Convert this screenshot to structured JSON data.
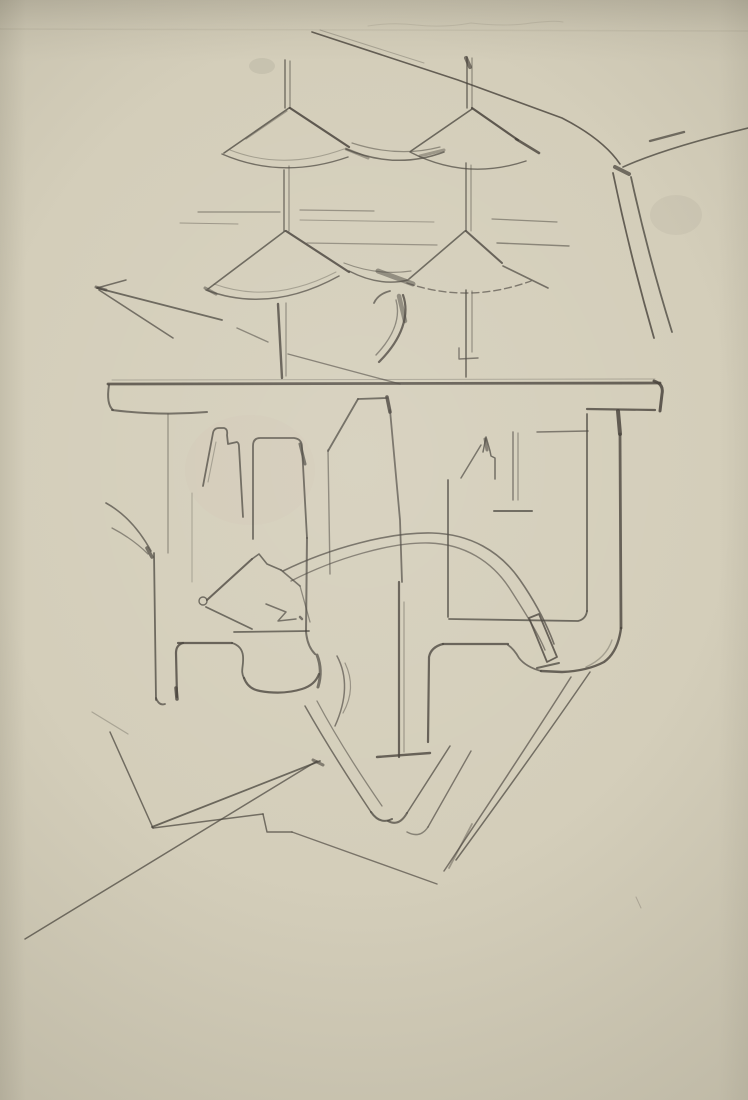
{
  "artwork": {
    "type": "pencil-sketch-photo",
    "description": "Hand-drawn pencil study: four conical umbrella roofs on thin masts above a plan-like structure with towers, U-channels, rounded feet and sweeping road lines on cream paper",
    "paper_color": "#d4ceba",
    "paper_shadow_color": "#c7c1ae",
    "pencil_color": "#46413a"
  },
  "canvas": {
    "width": 748,
    "height": 1100
  },
  "smudges": [
    {
      "name": "graphite-smudge-top-left-of-mast",
      "cx": 262,
      "cy": 66,
      "rx": 13,
      "ry": 8,
      "o": 0.1,
      "fill": "#5a554a"
    },
    {
      "name": "graphite-smudge-right-of-road",
      "cx": 676,
      "cy": 215,
      "rx": 26,
      "ry": 20,
      "o": 0.06,
      "fill": "#5a554a"
    },
    {
      "name": "warm-tint-left-chamber",
      "cx": 250,
      "cy": 470,
      "rx": 65,
      "ry": 55,
      "o": 0.05,
      "fill": "#c89f96"
    }
  ],
  "strokes": [
    {
      "name": "faint-top-scribble",
      "d": "M368,26 q25,-4 48,-1 q28,3 55,-2 q35,4 60,0 q25,-3 32,-1",
      "w": 1,
      "o": 0.12
    },
    {
      "name": "paper-crease-line",
      "d": "M0,29 L748,31",
      "w": 1.5,
      "o": 0.07
    },
    {
      "name": "left-mast-upper-a",
      "d": "M285,60 L285,108",
      "w": 1.4,
      "o": 0.7
    },
    {
      "name": "left-mast-upper-b",
      "d": "M290,61 L290,108",
      "w": 1.2,
      "o": 0.55
    },
    {
      "name": "left-mast-mid-a",
      "d": "M284,170 L284,231",
      "w": 1.4,
      "o": 0.7
    },
    {
      "name": "left-mast-mid-b",
      "d": "M289,166 L289,231",
      "w": 1.2,
      "o": 0.5
    },
    {
      "name": "left-mast-lower-a",
      "d": "M278,304 L282,378",
      "w": 2.4,
      "o": 0.8
    },
    {
      "name": "left-mast-lower-b",
      "d": "M286,303 L286,376",
      "w": 1.2,
      "o": 0.5
    },
    {
      "name": "right-mast-upper-a",
      "d": "M467,57 L467,108",
      "w": 1.4,
      "o": 0.75
    },
    {
      "name": "right-mast-upper-b",
      "d": "M472,58 L472,108",
      "w": 1.2,
      "o": 0.5
    },
    {
      "name": "right-mast-top-blob",
      "d": "M466,58 L470,67",
      "w": 4,
      "o": 0.65
    },
    {
      "name": "right-mast-mid-a",
      "d": "M466,163 L466,231",
      "w": 1.4,
      "o": 0.7
    },
    {
      "name": "right-mast-mid-b",
      "d": "M471,165 L471,231",
      "w": 1.1,
      "o": 0.5
    },
    {
      "name": "right-mast-lower-a",
      "d": "M466,290 L466,377",
      "w": 1.6,
      "o": 0.75
    },
    {
      "name": "right-mast-lower-b",
      "d": "M472,291 L472,352",
      "w": 1.2,
      "o": 0.5
    },
    {
      "name": "right-mast-collar",
      "d": "M459,348 L459,359 L478,358",
      "w": 1.4,
      "o": 0.65
    },
    {
      "name": "cone1-left-edge",
      "d": "M289,108 L224,153",
      "w": 1.6,
      "o": 0.75
    },
    {
      "name": "cone1-left-edge-double",
      "d": "M287,111 L246,139",
      "w": 1.2,
      "o": 0.4
    },
    {
      "name": "cone1-right-edge",
      "d": "M290,108 L349,147",
      "w": 2.2,
      "o": 0.85
    },
    {
      "name": "cone1-bottom-arc",
      "d": "M222,154 Q282,180 348,157",
      "w": 1.4,
      "o": 0.7
    },
    {
      "name": "cone1-bottom-arc-double",
      "d": "M230,150 Q284,171 344,149",
      "w": 1,
      "o": 0.35
    },
    {
      "name": "cone2-left-edge",
      "d": "M472,109 L411,151",
      "w": 1.6,
      "o": 0.75
    },
    {
      "name": "cone2-right-edge",
      "d": "M472,108 L518,140",
      "w": 2.2,
      "o": 0.85
    },
    {
      "name": "cone2-right-tip-dark",
      "d": "M516,139 L539,153",
      "w": 2.6,
      "o": 0.8
    },
    {
      "name": "cone2-bottom-arc",
      "d": "M410,152 Q466,181 526,161",
      "w": 1.4,
      "o": 0.7
    },
    {
      "name": "swag-cone1-cone2-a",
      "d": "M346,149 Q396,170 444,152",
      "w": 1.5,
      "o": 0.7
    },
    {
      "name": "swag-cone1-cone2-b",
      "d": "M352,143 Q398,158 440,147",
      "w": 1.2,
      "o": 0.5
    },
    {
      "name": "swag12-dark-left",
      "d": "M346,149 L368,158",
      "w": 3,
      "o": 0.4
    },
    {
      "name": "swag12-dark-right",
      "d": "M420,156 L444,150",
      "w": 3,
      "o": 0.4
    },
    {
      "name": "cone3-left-edge",
      "d": "M285,231 L208,289",
      "w": 1.6,
      "o": 0.75
    },
    {
      "name": "cone3-right-edge",
      "d": "M286,231 L349,272",
      "w": 2.2,
      "o": 0.85
    },
    {
      "name": "cone3-bottom-arc",
      "d": "M206,290 Q270,314 339,276",
      "w": 1.5,
      "o": 0.7
    },
    {
      "name": "cone3-bottom-arc-double",
      "d": "M214,284 Q272,305 336,272",
      "w": 1,
      "o": 0.35
    },
    {
      "name": "cone3-left-tip-dark",
      "d": "M205,288 L216,294",
      "w": 3,
      "o": 0.5
    },
    {
      "name": "cone4-left-edge",
      "d": "M465,231 L409,279",
      "w": 1.6,
      "o": 0.75
    },
    {
      "name": "cone4-right-edge",
      "d": "M466,231 L502,263",
      "w": 2,
      "o": 0.8
    },
    {
      "name": "cone4-right-extension",
      "d": "M503,266 L548,288",
      "w": 1.6,
      "o": 0.7
    },
    {
      "name": "cone4-bottom-arc-hatched",
      "d": "M407,283 Q468,304 531,281",
      "w": 1.4,
      "o": 0.65,
      "dash": "7 4"
    },
    {
      "name": "swag-cone3-cone4-a",
      "d": "M349,271 Q380,287 408,280",
      "w": 1.5,
      "o": 0.7
    },
    {
      "name": "swag-cone3-cone4-b",
      "d": "M344,263 Q378,276 411,271",
      "w": 1.2,
      "o": 0.5
    },
    {
      "name": "swag34-dark-wedge",
      "d": "M378,271 L413,284",
      "w": 5,
      "o": 0.5
    },
    {
      "name": "curl-hook",
      "d": "M390,291 Q378,294 374,303",
      "w": 1.8,
      "o": 0.7
    },
    {
      "name": "curl-outer",
      "d": "M403,295 C410,315 402,339 379,362",
      "w": 2.2,
      "o": 0.8
    },
    {
      "name": "curl-inner",
      "d": "M396,300 C401,318 393,337 376,355",
      "w": 1.4,
      "o": 0.55
    },
    {
      "name": "curl-dark-core",
      "d": "M399,296 L405,321",
      "w": 4.5,
      "o": 0.5
    },
    {
      "name": "road-main-diagonal",
      "d": "M312,32 L458,80 L562,118 Q603,139 620,164",
      "w": 1.6,
      "o": 0.8
    },
    {
      "name": "road-main-diagonal-double",
      "d": "M320,30 L424,63",
      "w": 1,
      "o": 0.3
    },
    {
      "name": "road-branch-upper-right",
      "d": "M623,167 Q665,148 748,128",
      "w": 1.6,
      "o": 0.75
    },
    {
      "name": "road-branch-dark-restroke",
      "d": "M650,141 L684,132",
      "w": 2.4,
      "o": 0.7
    },
    {
      "name": "road-junction-blob",
      "d": "M615,167 L629,174",
      "w": 4,
      "o": 0.7
    },
    {
      "name": "road-down-branch-a",
      "d": "M613,173 Q630,255 654,338",
      "w": 1.8,
      "o": 0.8
    },
    {
      "name": "road-down-branch-b",
      "d": "M631,177 Q648,255 672,332",
      "w": 1.8,
      "o": 0.75
    },
    {
      "name": "bar-top-twin-line",
      "d": "M112,380 L655,379",
      "w": 1,
      "o": 0.3
    },
    {
      "name": "bar-main-line",
      "d": "M108,384 L660,383",
      "w": 2.8,
      "o": 0.8
    },
    {
      "name": "bar-left-end-curl",
      "d": "M109,385 Q106,404 113,410",
      "w": 2,
      "o": 0.7
    },
    {
      "name": "bar-left-ledge",
      "d": "M112,410 Q160,416 207,412",
      "w": 2,
      "o": 0.7
    },
    {
      "name": "bar-right-end-hook",
      "d": "M654,381 Q664,384 662,394 L660,411",
      "w": 3,
      "o": 0.85
    },
    {
      "name": "bar-right-lower-line",
      "d": "M587,409 L655,410",
      "w": 2.2,
      "o": 0.8
    },
    {
      "name": "inner-vertical-corner-blob",
      "d": "M618,411 L620,434",
      "w": 4,
      "o": 0.85
    },
    {
      "name": "left-chamber-thin-wall",
      "d": "M168,414 L168,553",
      "w": 1.2,
      "o": 0.5
    },
    {
      "name": "tower1-outline",
      "d": "M203,486 L213,433 Q214,428 219,428 L224,428 Q228,429 227,435 L228,444 L237,442 Q239,443 239,447 L243,517",
      "w": 1.8,
      "o": 0.75
    },
    {
      "name": "tower1-inner-stroke",
      "d": "M208,482 L216,442",
      "w": 1.1,
      "o": 0.35
    },
    {
      "name": "faint-vertical-left",
      "d": "M192,493 L192,582",
      "w": 1,
      "o": 0.35
    },
    {
      "name": "tower2-outline",
      "d": "M253,539 L253,446 Q253,438 260,438 L294,438 Q302,439 302,447 L307,538",
      "w": 1.8,
      "o": 0.75
    },
    {
      "name": "tower2-corner-dark",
      "d": "M300,444 L305,464",
      "w": 3,
      "o": 0.7
    },
    {
      "name": "tower2-right-lower-vertical",
      "d": "M307,538 L306,631",
      "w": 2,
      "o": 0.7
    },
    {
      "name": "tower3-left-edge",
      "d": "M330,574 L328,450",
      "w": 1.4,
      "o": 0.55
    },
    {
      "name": "tower3-slant-top",
      "d": "M328,451 L358,399",
      "w": 1.8,
      "o": 0.75
    },
    {
      "name": "tower3-top-edge",
      "d": "M358,399 L387,398",
      "w": 1.8,
      "o": 0.75
    },
    {
      "name": "tower3-corner-dark",
      "d": "M387,397 L390,412",
      "w": 3.5,
      "o": 0.85
    },
    {
      "name": "tower3-right-edge",
      "d": "M390,410 L400,520 L402,582",
      "w": 1.8,
      "o": 0.7
    },
    {
      "name": "kite-tip-circle",
      "d": "M199,601 a4,4 0 1 0 8,0 a4,4 0 1 0 -8,0",
      "w": 1.4,
      "o": 0.75
    },
    {
      "name": "kite-upper-edge",
      "d": "M207,600 L252,559",
      "w": 2,
      "o": 0.8
    },
    {
      "name": "kite-notch",
      "d": "M252,559 L259,554 L267,564 L281,570",
      "w": 1.6,
      "o": 0.75
    },
    {
      "name": "kite-right-edge",
      "d": "M281,570 L300,586",
      "w": 1.6,
      "o": 0.7
    },
    {
      "name": "kite-right-lower-line",
      "d": "M300,586 L310,622",
      "w": 1.3,
      "o": 0.55
    },
    {
      "name": "kite-lower-edge",
      "d": "M206,607 L252,629",
      "w": 1.8,
      "o": 0.75
    },
    {
      "name": "kite-bottom-line",
      "d": "M234,632 L309,631",
      "w": 1.8,
      "o": 0.75
    },
    {
      "name": "kite-inner-zigzag",
      "d": "M266,604 L286,612 L278,621 L296,619",
      "w": 1.5,
      "o": 0.7
    },
    {
      "name": "kite-inner-dot",
      "d": "M300,617 L302,619",
      "w": 2.5,
      "o": 0.7
    },
    {
      "name": "ramp-curve-a",
      "d": "M283,571 C330,548 390,532 432,533 C470,534 500,551 520,580 C536,603 547,625 554,644",
      "w": 1.6,
      "o": 0.7
    },
    {
      "name": "ramp-curve-b",
      "d": "M291,581 C336,558 392,542 429,543 C464,544 492,561 510,589 C524,611 537,631 545,650",
      "w": 1.4,
      "o": 0.6
    },
    {
      "name": "chimney-diagonal",
      "d": "M461,478 L481,445",
      "w": 1.5,
      "o": 0.7
    },
    {
      "name": "chimney-outline",
      "d": "M483,452 L486,437 L490,451 L491,456 L495,458 L495,479",
      "w": 1.5,
      "o": 0.75
    },
    {
      "name": "chimney-dark-tip",
      "d": "M485,439 L487,450",
      "w": 3,
      "o": 0.6
    },
    {
      "name": "right-chamber-double-vert-a",
      "d": "M513,432 L513,500",
      "w": 1.4,
      "o": 0.65
    },
    {
      "name": "right-chamber-double-vert-b",
      "d": "M518,433 L518,500",
      "w": 1.2,
      "o": 0.5
    },
    {
      "name": "right-chamber-base-tick",
      "d": "M494,511 L532,511",
      "w": 2,
      "o": 0.75
    },
    {
      "name": "right-chamber-horizontal",
      "d": "M537,432 L588,431",
      "w": 1.5,
      "o": 0.65
    },
    {
      "name": "right-chamber-left-wall",
      "d": "M448,480 L448,617",
      "w": 1.8,
      "o": 0.75
    },
    {
      "name": "right-chamber-bottom",
      "d": "M449,619 L578,621 Q586,619 587,611",
      "w": 1.8,
      "o": 0.75
    },
    {
      "name": "right-chamber-right-wall",
      "d": "M587,611 L587,414",
      "w": 1.8,
      "o": 0.75
    },
    {
      "name": "inner-thick-vertical",
      "d": "M620,434 L621,628",
      "w": 2.8,
      "o": 0.8
    },
    {
      "name": "right-leg-bottom-curve",
      "d": "M621,628 Q618,652 604,662 Q587,671 562,672 L541,671",
      "w": 2.4,
      "o": 0.8
    },
    {
      "name": "right-leg-valley",
      "d": "M541,671 Q526,667 519,658 Q514,649 508,645",
      "w": 1.8,
      "o": 0.7
    },
    {
      "name": "right-leg-inner-horizontal",
      "d": "M443,644 L508,644",
      "w": 2.2,
      "o": 0.8
    },
    {
      "name": "right-leg-left-corner",
      "d": "M443,644 Q431,647 429,657 L428,742",
      "w": 2.2,
      "o": 0.8
    },
    {
      "name": "right-leg-inner-shadow",
      "d": "M612,640 Q606,658 586,667",
      "w": 1.4,
      "o": 0.35
    },
    {
      "name": "central-leg-left-edge",
      "d": "M399,582 L399,757",
      "w": 2.2,
      "o": 0.8
    },
    {
      "name": "central-leg-twin",
      "d": "M404,602 L404,752",
      "w": 1.2,
      "o": 0.4
    },
    {
      "name": "central-leg-foot",
      "d": "M377,757 L430,753",
      "w": 2.4,
      "o": 0.8
    },
    {
      "name": "rotated-rectangle",
      "d": "M529,618 L539,614 L557,657 L547,662 Z",
      "w": 1.8,
      "o": 0.8
    },
    {
      "name": "rotated-rectangle-tick",
      "d": "M537,668 L559,663",
      "w": 2,
      "o": 0.75
    },
    {
      "name": "left-outer-wall",
      "d": "M154,553 L156,700",
      "w": 1.8,
      "o": 0.75
    },
    {
      "name": "left-outer-wall-hook",
      "d": "M156,698 Q159,706 165,704",
      "w": 1.8,
      "o": 0.7
    },
    {
      "name": "grass-blade-a",
      "d": "M106,503 Q133,518 151,551",
      "w": 1.6,
      "o": 0.7
    },
    {
      "name": "grass-blade-b",
      "d": "M112,528 Q133,539 148,554",
      "w": 1.3,
      "o": 0.55
    },
    {
      "name": "grass-blade-dark-tip",
      "d": "M147,548 L152,557",
      "w": 3.5,
      "o": 0.7
    },
    {
      "name": "left-foot-top",
      "d": "M178,643 L232,643",
      "w": 2.2,
      "o": 0.8
    },
    {
      "name": "left-foot-left-corner",
      "d": "M183,643 Q176,645 176,653 L177,697",
      "w": 2.2,
      "o": 0.8
    },
    {
      "name": "left-foot-left-dark-end",
      "d": "M176,688 L177,699",
      "w": 3.5,
      "o": 0.8
    },
    {
      "name": "left-foot-right-corner",
      "d": "M232,643 Q242,646 243,656 C244,666 240,671 244,678",
      "w": 1.8,
      "o": 0.75
    },
    {
      "name": "central-foot-bottom-curve",
      "d": "M244,678 Q248,689 260,691 Q283,695 302,689 Q315,685 319,674",
      "w": 2.2,
      "o": 0.8
    },
    {
      "name": "central-foot-knob",
      "d": "M317,655 Q323,670 318,687",
      "w": 3,
      "o": 0.7
    },
    {
      "name": "central-foot-corner",
      "d": "M306,631 Q307,646 315,654",
      "w": 2,
      "o": 0.7
    },
    {
      "name": "parenthesis-arc-a",
      "d": "M337,656 Q353,686 335,726",
      "w": 1.5,
      "o": 0.65
    },
    {
      "name": "parenthesis-arc-b",
      "d": "M345,663 Q357,688 343,713",
      "w": 1.2,
      "o": 0.45
    },
    {
      "name": "se-road-a",
      "d": "M305,706 Q331,752 371,812",
      "w": 1.5,
      "o": 0.7
    },
    {
      "name": "se-road-b",
      "d": "M317,701 Q342,748 382,806",
      "w": 1.3,
      "o": 0.55
    },
    {
      "name": "se-road-hook",
      "d": "M371,812 Q380,825 392,819",
      "w": 2,
      "o": 0.75
    },
    {
      "name": "ne-road-a",
      "d": "M450,746 L407,813",
      "w": 1.5,
      "o": 0.7
    },
    {
      "name": "ne-road-b",
      "d": "M471,751 L428,827",
      "w": 1.4,
      "o": 0.65
    },
    {
      "name": "ne-road-hook-a",
      "d": "M407,813 Q399,827 388,821",
      "w": 2,
      "o": 0.7
    },
    {
      "name": "ne-road-hook-b",
      "d": "M428,827 Q420,839 407,832",
      "w": 1.5,
      "o": 0.55
    },
    {
      "name": "sw-road-a",
      "d": "M590,672 Q540,745 456,860",
      "w": 1.5,
      "o": 0.7
    },
    {
      "name": "sw-road-b",
      "d": "M571,677 Q526,748 444,871",
      "w": 1.5,
      "o": 0.65
    },
    {
      "name": "sw-road-tail-restroke",
      "d": "M472,824 L449,868",
      "w": 1.8,
      "o": 0.4
    },
    {
      "name": "bottomleft-edge-up",
      "d": "M110,732 L153,828",
      "w": 1.5,
      "o": 0.7
    },
    {
      "name": "bottomleft-top-edge",
      "d": "M152,827 L320,761",
      "w": 1.8,
      "o": 0.75
    },
    {
      "name": "bottomleft-low-edge",
      "d": "M153,828 L263,814",
      "w": 1.5,
      "o": 0.7
    },
    {
      "name": "bottomleft-notch",
      "d": "M263,814 L267,832 L292,832",
      "w": 1.5,
      "o": 0.7
    },
    {
      "name": "bottomleft-se-edge",
      "d": "M292,832 L437,884",
      "w": 1.4,
      "o": 0.65
    },
    {
      "name": "bottomleft-long-diagonal",
      "d": "M25,939 L317,761",
      "w": 1.5,
      "o": 0.7
    },
    {
      "name": "bottomleft-corner-dark",
      "d": "M313,760 L323,765",
      "w": 3,
      "o": 0.6
    },
    {
      "name": "faint-diagonal-left",
      "d": "M92,712 L128,734",
      "w": 1.2,
      "o": 0.3
    },
    {
      "name": "wedge-top-edge",
      "d": "M97,288 L222,320",
      "w": 1.8,
      "o": 0.75
    },
    {
      "name": "wedge-lower-edge",
      "d": "M99,290 L173,338",
      "w": 1.6,
      "o": 0.7
    },
    {
      "name": "wedge-small-edge",
      "d": "M97,288 L126,280",
      "w": 1.5,
      "o": 0.7
    },
    {
      "name": "wedge-tip-dark",
      "d": "M96,287 L106,290",
      "w": 3,
      "o": 0.6
    },
    {
      "name": "short-diagonal-near-mast",
      "d": "M237,328 L268,342",
      "w": 1.4,
      "o": 0.55
    },
    {
      "name": "diagonal-to-bar",
      "d": "M288,354 L400,384",
      "w": 1.4,
      "o": 0.6
    },
    {
      "name": "guide-line-1",
      "d": "M198,212 L280,212",
      "w": 1.2,
      "o": 0.5
    },
    {
      "name": "guide-line-2",
      "d": "M300,210 L374,211",
      "w": 1.2,
      "o": 0.45
    },
    {
      "name": "guide-line-3",
      "d": "M180,223 L238,224",
      "w": 1,
      "o": 0.4
    },
    {
      "name": "guide-line-4",
      "d": "M300,220 L434,222",
      "w": 1,
      "o": 0.4
    },
    {
      "name": "guide-line-5",
      "d": "M492,219 L557,222",
      "w": 1.2,
      "o": 0.5
    },
    {
      "name": "guide-line-6",
      "d": "M307,243 L437,245",
      "w": 1.2,
      "o": 0.45
    },
    {
      "name": "guide-line-7",
      "d": "M497,243 L569,246",
      "w": 1.4,
      "o": 0.55
    },
    {
      "name": "faint-scratch-bottom-right",
      "d": "M636,897 L641,908",
      "w": 1,
      "o": 0.25
    }
  ]
}
